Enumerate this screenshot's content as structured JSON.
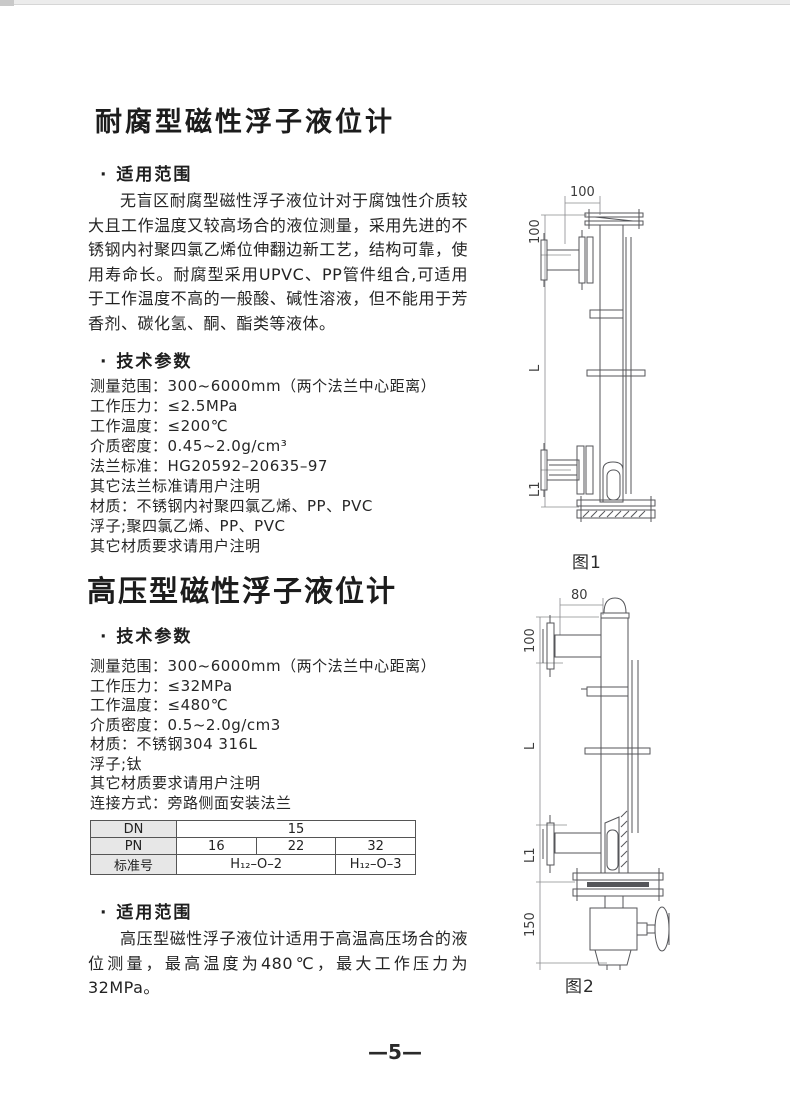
{
  "page": {
    "number": "—5—"
  },
  "section1": {
    "title": "耐腐型磁性浮子液位计",
    "scope_heading": "· 适用范围",
    "scope_text": "无盲区耐腐型磁性浮子液位计对于腐蚀性介质较大且工作温度又较高场合的液位测量，采用先进的不锈钢内衬聚四氯乙烯位伸翻边新工艺，结构可靠，使用寿命长。耐腐型采用UPVC、PP管件组合,可适用于工作温度不高的一般酸、碱性溶液，但不能用于芳香剂、碳化氢、酮、酯类等液体。",
    "params_heading": "· 技术参数",
    "params": [
      "测量范围：300~6000mm（两个法兰中心距离）",
      "工作压力：≤2.5MPa",
      "工作温度：≤200℃",
      "介质密度：0.45~2.0g/cm³",
      "法兰标准：HG20592–20635–97",
      "其它法兰标准请用户注明",
      "材质：不锈钢内衬聚四氯乙烯、PP、PVC",
      "浮子;聚四氯乙烯、PP、PVC",
      "其它材质要求请用户注明"
    ]
  },
  "section2": {
    "title": "高压型磁性浮子液位计",
    "params_heading": "· 技术参数",
    "params": [
      "测量范围：300~6000mm（两个法兰中心距离）",
      "工作压力：≤32MPa",
      "工作温度：≤480℃",
      "介质密度：0.5~2.0g/cm3",
      "材质：不锈钢304  316L",
      "浮子;钛",
      "其它材质要求请用户注明",
      "连接方式：旁路侧面安装法兰"
    ],
    "scope_heading": "· 适用范围",
    "scope_text": "高压型磁性浮子液位计适用于高温高压场合的液位测量，最高温度为480℃，最大工作压力为32MPa。"
  },
  "spec_table": {
    "row1": {
      "label": "DN",
      "value": "15"
    },
    "row2": {
      "label": "PN",
      "v1": "16",
      "v2": "22",
      "v3": "32"
    },
    "row3": {
      "label": "标准号",
      "v1": "H₁₂–O–2",
      "v2": "H₁₂–O–3"
    }
  },
  "figure1": {
    "caption": "图1",
    "dims": {
      "top": "100",
      "upper": "100",
      "mid": "L",
      "lower": "L1"
    }
  },
  "figure2": {
    "caption": "图2",
    "dims": {
      "top": "80",
      "upper": "100",
      "mid": "L",
      "lower": "L1",
      "bottom": "150"
    }
  }
}
